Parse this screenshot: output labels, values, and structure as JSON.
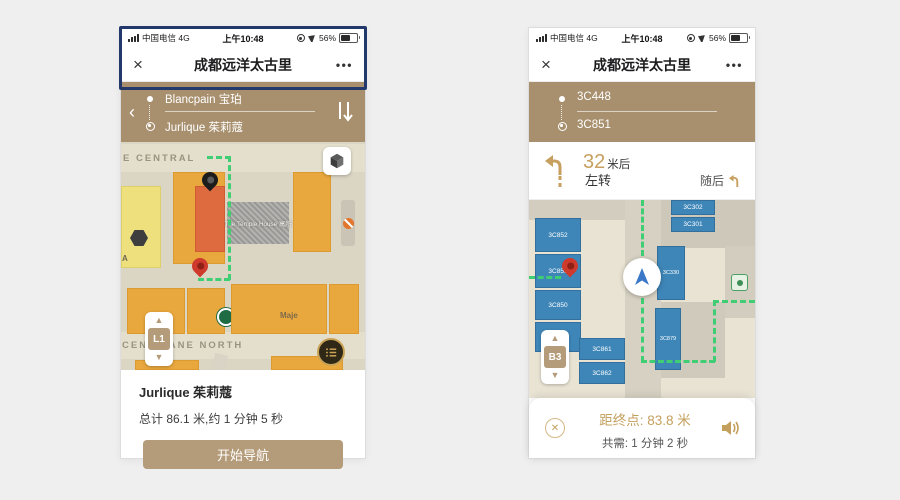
{
  "left": {
    "status": {
      "carrier": "中国电信",
      "net": "4G",
      "time": "上午10:48",
      "battery": "56%"
    },
    "nav": {
      "close": "×",
      "title": "成都远洋太古里",
      "more": "•••"
    },
    "route": {
      "back": "‹",
      "from": "Blancpain 宝珀",
      "to": "Jurlique 茱莉蔻"
    },
    "map": {
      "street_top": "E CENTRAL",
      "street_cen": "CEN",
      "street_bottom": "LANE NORTH",
      "hotel": "The Temple House 寓所",
      "maje": "Maje",
      "zone_a": "A",
      "floor": "L1"
    },
    "summary": {
      "name": "Jurlique 茱莉蔻",
      "total": "总计 86.1 米,约 1 分钟 5 秒",
      "button": "开始导航"
    }
  },
  "right": {
    "status": {
      "carrier": "中国电信",
      "net": "4G",
      "time": "上午10:48",
      "battery": "56%"
    },
    "nav": {
      "close": "×",
      "title": "成都远洋太古里",
      "more": "•••"
    },
    "route": {
      "from": "3C448",
      "to": "3C851"
    },
    "turn": {
      "distance": "32",
      "unit": "米后",
      "action": "左转",
      "next": "随后"
    },
    "map": {
      "floor": "B3",
      "b852": "3C852",
      "b851": "3C851",
      "b850": "3C850",
      "b849": "3C849",
      "b861": "3C861",
      "b862": "3C862",
      "b330": "3C330",
      "b879": "3C879",
      "b302": "3C302",
      "b301": "3C301"
    },
    "bottom": {
      "dist_label": "距终点:",
      "dist": "83.8 米",
      "time_label": "共需:",
      "time": "1 分钟 2 秒"
    }
  }
}
